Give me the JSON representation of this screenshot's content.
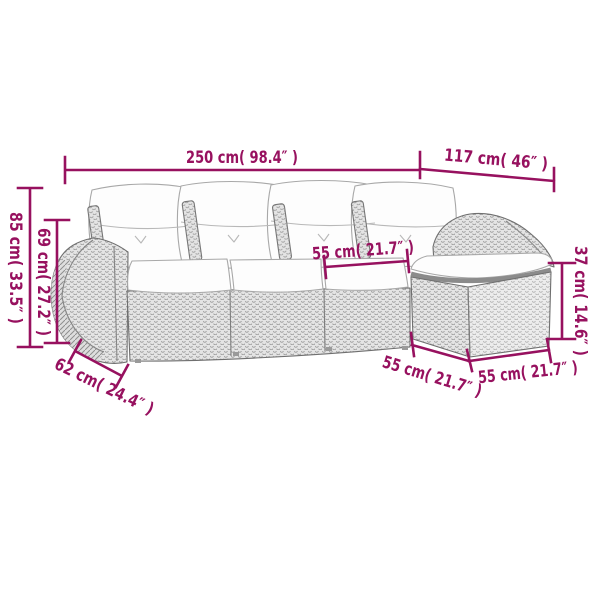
{
  "colors": {
    "background": "#ffffff",
    "dimension_accent": "#97115F",
    "furniture_outline": "#6f6f6f",
    "wicker_fill": "#e4e4e4",
    "wicker_texture": "#9c9c9c",
    "cushion_fill": "#fdfdfd"
  },
  "dimensions": {
    "total_width": {
      "text": "250 cm( 98.4″ )",
      "cm": 250,
      "inches": 98.4
    },
    "chaise_depth": {
      "text": "117 cm( 46″ )",
      "cm": 117,
      "inches": 46
    },
    "total_height": {
      "text": "85 cm( 33.5″ )",
      "cm": 85,
      "inches": 33.5
    },
    "back_height": {
      "text": "69 cm( 27.2″ )",
      "cm": 69,
      "inches": 27.2
    },
    "seat_width": {
      "text": "55 cm( 21.7″ )",
      "cm": 55,
      "inches": 21.7
    },
    "footstool_height": {
      "text": "37 cm( 14.6″ )",
      "cm": 37,
      "inches": 14.6
    },
    "armrest_depth": {
      "text": "62 cm( 24.4″ )",
      "cm": 62,
      "inches": 24.4
    },
    "seat_depth": {
      "text": "55 cm( 21.7″ )",
      "cm": 55,
      "inches": 21.7
    },
    "footstool_width": {
      "text": "55 cm( 21.7″ )",
      "cm": 55,
      "inches": 21.7
    }
  }
}
